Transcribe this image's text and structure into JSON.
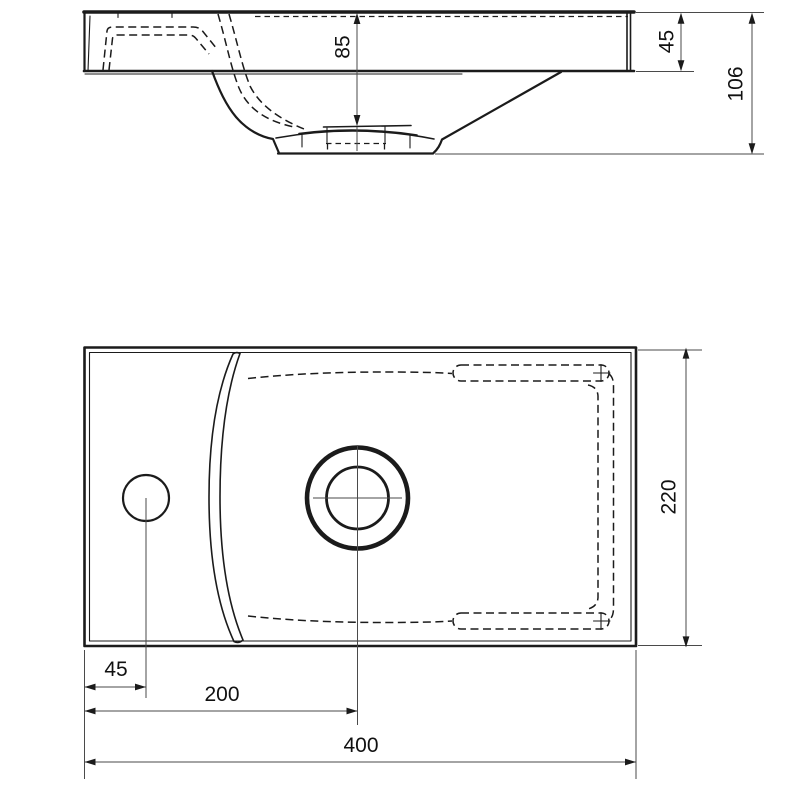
{
  "drawing": {
    "title": "washbasin-technical-drawing",
    "palette": {
      "background": "#ffffff",
      "object_line": "#1b1b1b",
      "dimension_line": "#4a4a4a",
      "text": "#111111"
    },
    "side_view": {
      "dims": {
        "bowl_depth": {
          "label": "85"
        },
        "deck_thickness": {
          "label": "45"
        },
        "overall_height": {
          "label": "106"
        }
      }
    },
    "plan_view": {
      "dims": {
        "overall_depth": {
          "label": "220"
        },
        "tap_hole_offset": {
          "label": "45"
        },
        "drain_center_offset": {
          "label": "200"
        },
        "overall_width": {
          "label": "400"
        }
      }
    }
  }
}
